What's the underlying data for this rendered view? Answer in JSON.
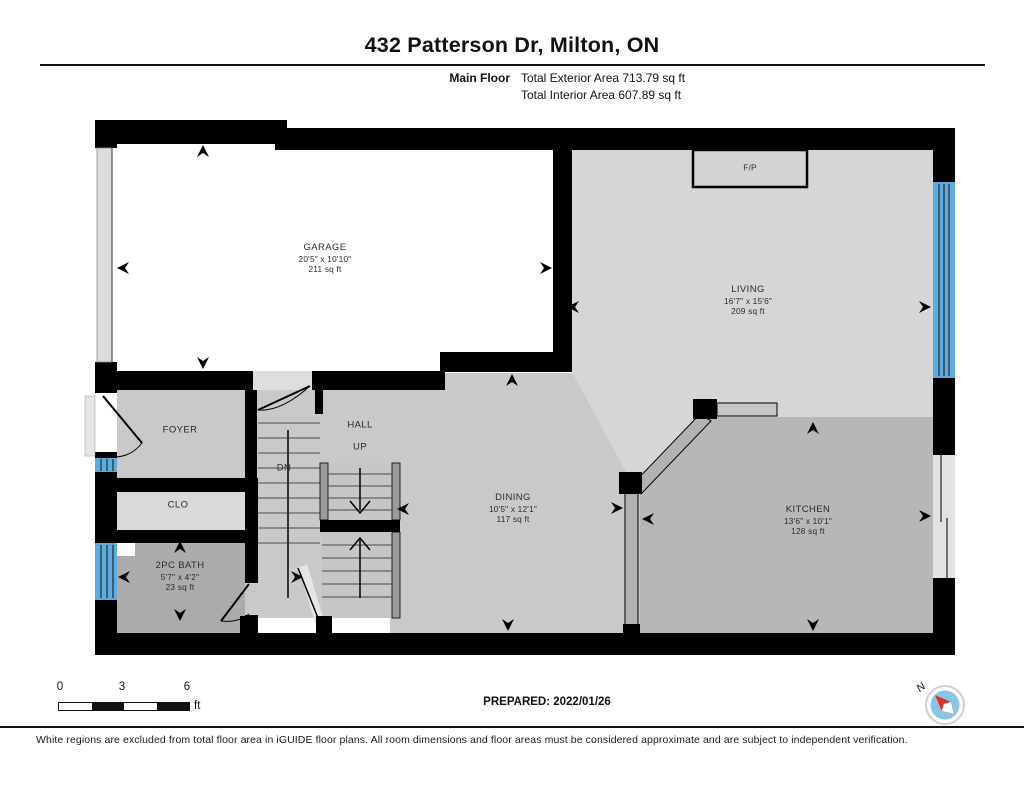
{
  "header": {
    "title": "432 Patterson Dr, Milton, ON",
    "floor_label": "Main Floor",
    "total_exterior": "Total Exterior Area 713.79 sq ft",
    "total_interior": "Total Interior Area 607.89 sq ft"
  },
  "rooms": {
    "garage": {
      "name": "GARAGE",
      "dims": "20'5\" x 10'10\"",
      "area": "211 sq ft"
    },
    "living": {
      "name": "LIVING",
      "dims": "16'7\" x 15'6\"",
      "area": "209 sq ft"
    },
    "dining": {
      "name": "DINING",
      "dims": "10'5\" x 12'1\"",
      "area": "117 sq ft"
    },
    "kitchen": {
      "name": "KITCHEN",
      "dims": "13'6\" x 10'1\"",
      "area": "128 sq ft"
    },
    "bath": {
      "name": "2PC BATH",
      "dims": "5'7\" x 4'2\"",
      "area": "23 sq ft"
    },
    "foyer": {
      "name": "FOYER"
    },
    "hall": {
      "name": "HALL"
    },
    "closet": {
      "name": "CLO"
    },
    "fireplace": {
      "name": "F/P"
    },
    "stair_up": "UP",
    "stair_down": "DN"
  },
  "footer": {
    "scale": {
      "tick0": "0",
      "tick1": "3",
      "tick2": "6",
      "unit": "ft"
    },
    "prepared": "PREPARED: 2022/01/26",
    "compass_label": "N",
    "disclaimer": "White regions are excluded from total floor area in iGUIDE floor plans. All room dimensions and floor areas must be considered approximate and are subject to independent verification."
  },
  "colors": {
    "window_blue": "#5fabdc",
    "compass_red": "#e03023",
    "compass_blue": "#8ac4e6"
  }
}
